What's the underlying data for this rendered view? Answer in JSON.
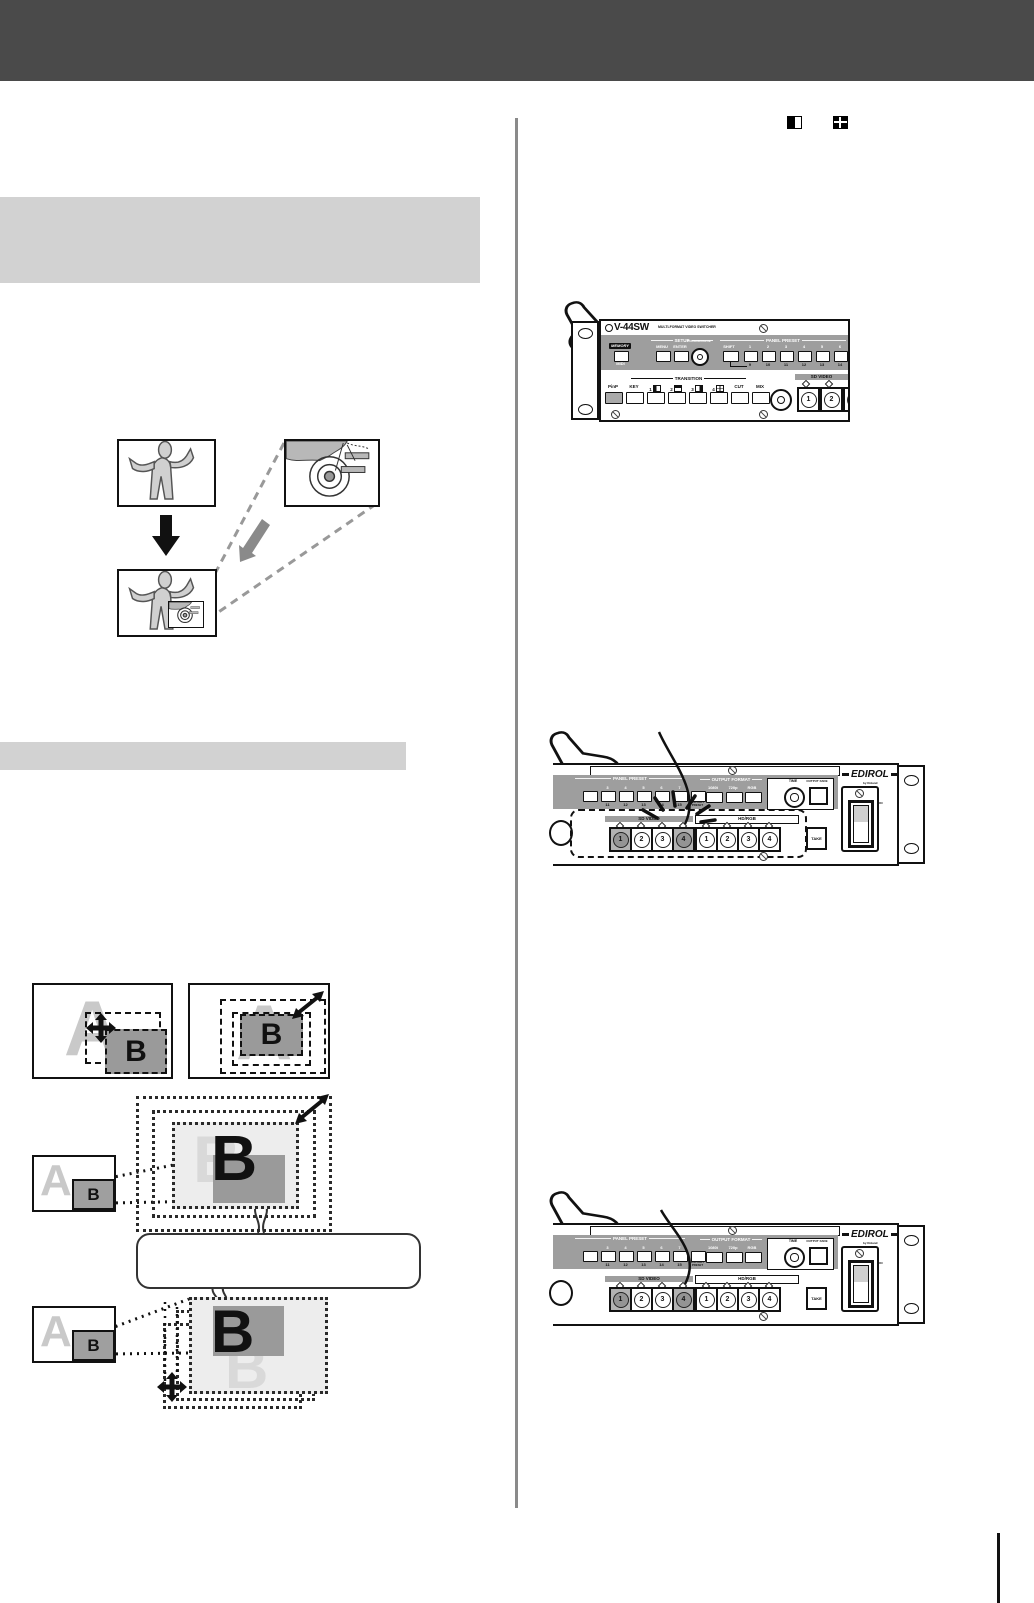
{
  "colors": {
    "header_bar": "#4a4a4a",
    "section_heading_bg": "#d2d2d2",
    "column_divider": "#8a8a8a",
    "panel_band_gray": "#9e9e9e",
    "pip_box_gray": "#9a9a9a",
    "ghost_letter_gray": "#c9c9c9"
  },
  "labels": {
    "a": "A",
    "b": "B"
  },
  "nums": [
    "1",
    "2",
    "3",
    "4"
  ],
  "device": {
    "model": "V-44SW",
    "model_sub": "MULTI-FORMAT VIDEO SWITCHER",
    "memory": "MEMORY",
    "midi": "MIDI",
    "setup": "SETUP",
    "menu": "MENU",
    "enter": "ENTER",
    "cursor_value": "CURSOR/VALUE",
    "panel_preset": "PANEL PRESET",
    "shift": "SHIFT",
    "preset_tops_p1": [
      "1",
      "2",
      "3",
      "4",
      "5",
      "6"
    ],
    "preset_subs_p1": [
      "9",
      "10",
      "11",
      "12",
      "13",
      "14"
    ],
    "preset_tops_p2": [
      "",
      "3",
      "4",
      "5",
      "6",
      "7",
      ""
    ],
    "preset_subs_p2": [
      "",
      "11",
      "12",
      "13",
      "14",
      "15",
      ""
    ],
    "factory_preset": "FACTORY PRESET",
    "transition": "TRANSITION",
    "transition_btns": [
      "PinP",
      "KEY",
      "1",
      "2",
      "3",
      "4",
      "CUT",
      "MIX"
    ],
    "time": "TIME",
    "sd_video": "SD VIDEO",
    "hd_rgb": "HD/RGB",
    "take": "TAKE",
    "output_format": "OUTPUT FORMAT",
    "formats": [
      "1080i",
      "720p",
      "RGB"
    ],
    "output_fade": "OUTPUT FADE",
    "brand": "EDIROL",
    "brand_sub": "by Roland",
    "on": "ON",
    "power": "POWER"
  }
}
